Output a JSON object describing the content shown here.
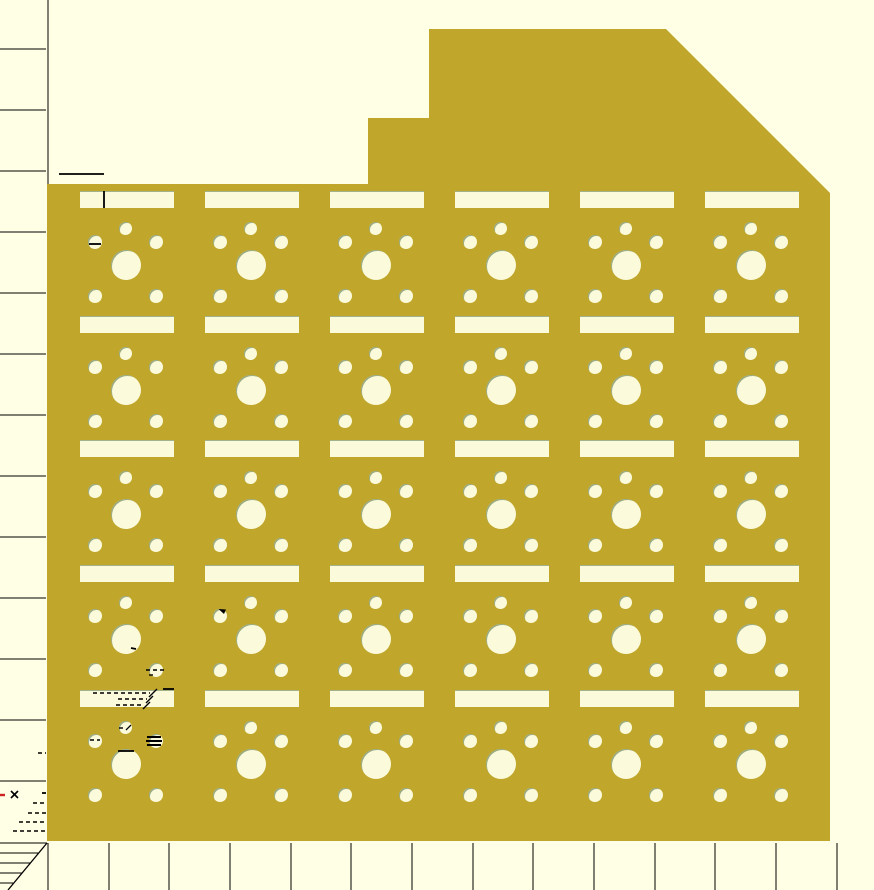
{
  "viewport": {
    "width": 874,
    "height": 890,
    "background_color": "#FFFFE5",
    "description": "CAD viewport preview of a perforated switch-plate panel with measurement rulers"
  },
  "colors": {
    "plate": "#C0A62A",
    "hole_fill": "#FBFADB",
    "hole_edge": "#4A6A3A",
    "line": "#000000",
    "red_mark": "#CC2222"
  },
  "plate": {
    "outline_points": [
      [
        47,
        184
      ],
      [
        368,
        184
      ],
      [
        368,
        118
      ],
      [
        429,
        118
      ],
      [
        429,
        29
      ],
      [
        666,
        29
      ],
      [
        830,
        193
      ],
      [
        830,
        841
      ],
      [
        47,
        841
      ]
    ]
  },
  "grid": {
    "columns_x": [
      80,
      205,
      330,
      455,
      580,
      705
    ],
    "rows_y": [
      191,
      316,
      440,
      565,
      690
    ],
    "cell": {
      "slot": {
        "x": 0,
        "y": 0,
        "w": 94,
        "h": 17
      },
      "circles": [
        {
          "name": "top-small-hole",
          "cx": 45.5,
          "cy": 37.5,
          "r": 6.5
        },
        {
          "name": "upper-left-small-hole",
          "cx": 15,
          "cy": 50.5,
          "r": 7
        },
        {
          "name": "upper-right-small-hole",
          "cx": 76,
          "cy": 50.5,
          "r": 7
        },
        {
          "name": "center-large-hole",
          "cx": 46,
          "cy": 73.5,
          "r": 15
        },
        {
          "name": "lower-left-small-hole",
          "cx": 15,
          "cy": 104.5,
          "r": 7
        },
        {
          "name": "lower-right-small-hole",
          "cx": 76,
          "cy": 104.5,
          "r": 7
        }
      ]
    }
  },
  "ruler": {
    "axis_line": {
      "x": 48,
      "y1": 0,
      "y2": 184
    },
    "left_ticks_y": [
      49,
      110,
      171,
      232,
      293,
      354,
      415,
      476,
      537,
      598,
      659,
      720,
      781
    ],
    "left_tick_x1": 0,
    "left_tick_x2": 46,
    "bottom_ticks_x": [
      48,
      109,
      169,
      230,
      291,
      351,
      412,
      473,
      533,
      594,
      655,
      715,
      776,
      837
    ],
    "bottom_tick_y1": 843,
    "bottom_tick_y2": 890,
    "corner_hatch": {
      "lines": [
        [
          0,
          843,
          47,
          843
        ],
        [
          0,
          853,
          38,
          853
        ],
        [
          0,
          863,
          30,
          863
        ],
        [
          0,
          873,
          22,
          873
        ],
        [
          0,
          883,
          13,
          883
        ]
      ],
      "diagonal": [
        47,
        843,
        8,
        890
      ]
    }
  },
  "annotations": {
    "solid_lines": [
      [
        59,
        174,
        104,
        174
      ],
      [
        104,
        191,
        104,
        208
      ],
      [
        89,
        244,
        101,
        244
      ],
      [
        163,
        689,
        174,
        689
      ],
      [
        118,
        751,
        134,
        751
      ],
      [
        42,
        793,
        46,
        793
      ],
      [
        131,
        648,
        136,
        649
      ]
    ],
    "dashed_lines": [
      [
        93,
        693,
        150,
        693
      ],
      [
        118,
        699,
        147,
        699
      ],
      [
        116,
        705,
        144,
        705
      ],
      [
        119,
        728,
        126,
        728
      ],
      [
        90,
        740,
        100,
        740
      ],
      [
        146,
        670,
        164,
        670
      ],
      [
        149,
        675,
        156,
        675
      ],
      [
        38,
        753,
        46,
        753
      ],
      [
        33,
        803,
        47,
        803
      ],
      [
        28,
        813,
        47,
        813
      ],
      [
        19,
        822,
        47,
        822
      ],
      [
        13,
        831,
        47,
        831
      ]
    ],
    "slashes": [
      [
        149,
        697,
        157,
        689
      ],
      [
        146,
        703,
        153,
        696
      ],
      [
        143,
        709,
        150,
        702
      ],
      [
        126,
        730,
        131,
        725
      ]
    ],
    "stripes": [
      [
        147,
        737,
        161,
        737
      ],
      [
        146,
        741,
        162,
        741
      ],
      [
        147,
        745,
        161,
        745
      ]
    ],
    "cross_lines": [
      [
        11,
        791,
        18,
        798
      ],
      [
        18,
        791,
        11,
        798
      ]
    ],
    "red_dash": [
      0,
      795,
      5,
      795
    ],
    "triangle": [
      [
        218.5,
        609
      ],
      [
        226,
        609.5
      ],
      [
        224,
        614
      ]
    ]
  }
}
